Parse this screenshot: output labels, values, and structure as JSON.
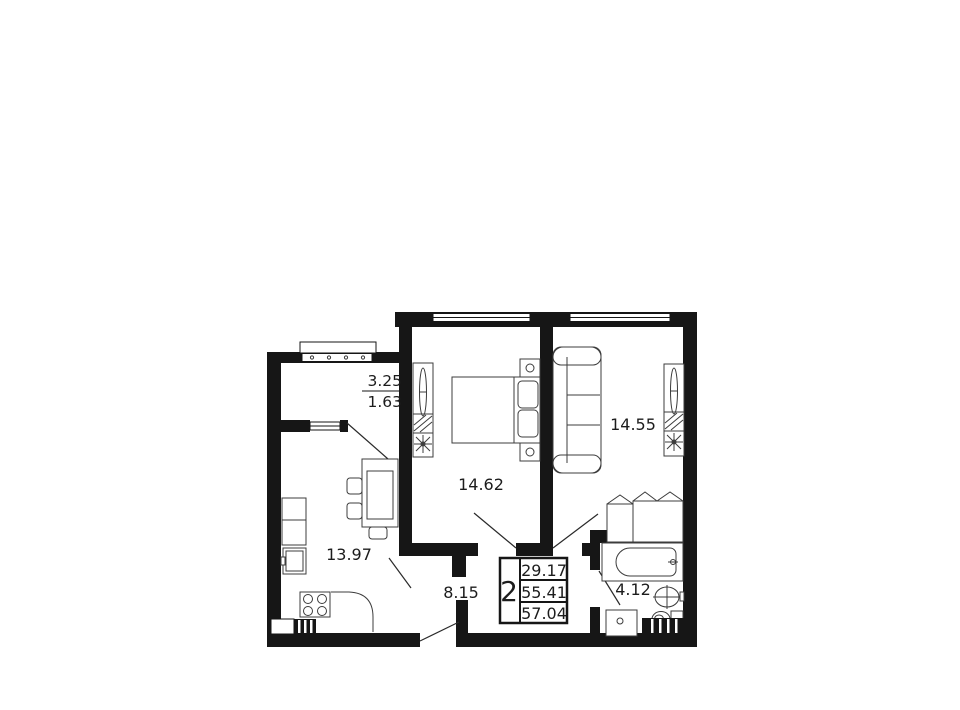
{
  "plan": {
    "type": "apartment-floor-plan",
    "colors": {
      "wall": "#161616",
      "background": "#ffffff",
      "furniture_stroke": "#3c3c3c",
      "text": "#1c1c1c"
    },
    "balcony": {
      "name": "balcony",
      "area_full": "3.25",
      "area_reduced": "1.63"
    },
    "bedroom": {
      "name": "bedroom",
      "area": "14.62"
    },
    "living_room": {
      "name": "living-room",
      "area": "14.55"
    },
    "kitchen": {
      "name": "kitchen",
      "area": "13.97"
    },
    "hallway": {
      "name": "hallway",
      "area": "8.15"
    },
    "bathroom": {
      "name": "bathroom",
      "area": "4.12"
    },
    "info_box": {
      "rooms_count": "2",
      "living_area": "29.17",
      "apartment_area": "55.41",
      "total_area": "57.04"
    }
  }
}
